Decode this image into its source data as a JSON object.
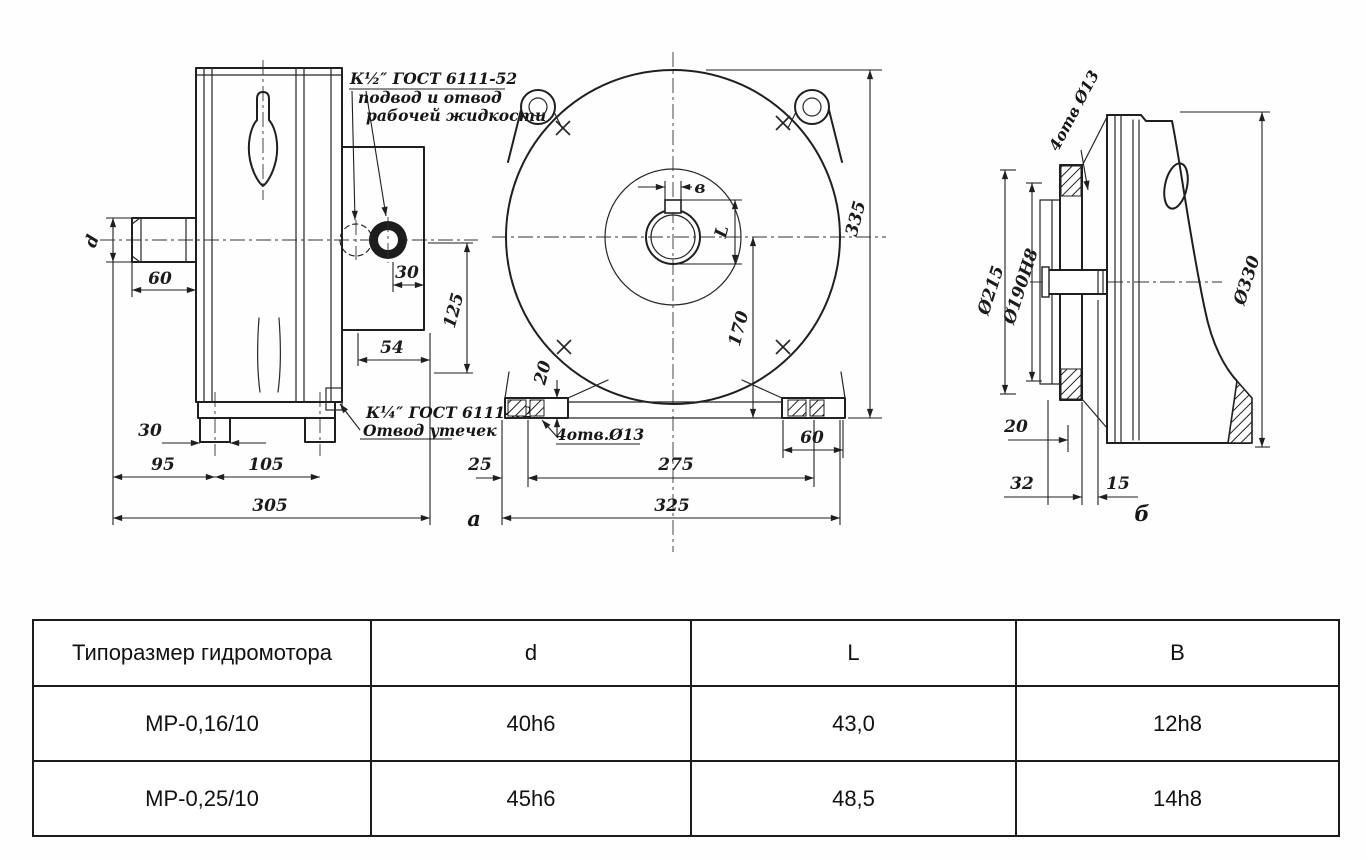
{
  "drawing": {
    "callout_supply": {
      "line1": "К½″ ГОСТ 6111-52",
      "line2": "подвод и отвод",
      "line3": "рабочей жидкости"
    },
    "callout_drain": {
      "line1": "К¼″ ГОСТ 6111-52",
      "line2": "Отвод утечек"
    },
    "view_a": {
      "label": "а",
      "shaft_label": "d",
      "dim_60": "60",
      "dim_30_port": "30",
      "dim_54": "54",
      "dim_125": "125",
      "dim_30_foot": "30",
      "dim_95": "95",
      "dim_105": "105",
      "dim_305": "305"
    },
    "view_front": {
      "keyway_width_label": "в",
      "keyway_depth_label": "L",
      "dim_335": "335",
      "dim_170": "170",
      "dim_20": "20",
      "holes_note": "4отв.Ø13",
      "dim_25": "25",
      "dim_275": "275",
      "dim_60": "60",
      "dim_325": "325"
    },
    "view_b": {
      "label": "б",
      "holes_note": "4отв Ø13",
      "dim_d215": "Ø215",
      "dim_d190": "Ø190H8",
      "dim_d330": "Ø330",
      "dim_20": "20",
      "dim_32": "32",
      "dim_15": "15"
    }
  },
  "table": {
    "headers": [
      "Типоразмер гидромотора",
      "d",
      "L",
      "B"
    ],
    "rows": [
      {
        "type": "МР-0,16/10",
        "d": "40h6",
        "l": "43,0",
        "b": "12h8"
      },
      {
        "type": "МР-0,25/10",
        "d": "45h6",
        "l": "48,5",
        "b": "14h8"
      }
    ]
  }
}
